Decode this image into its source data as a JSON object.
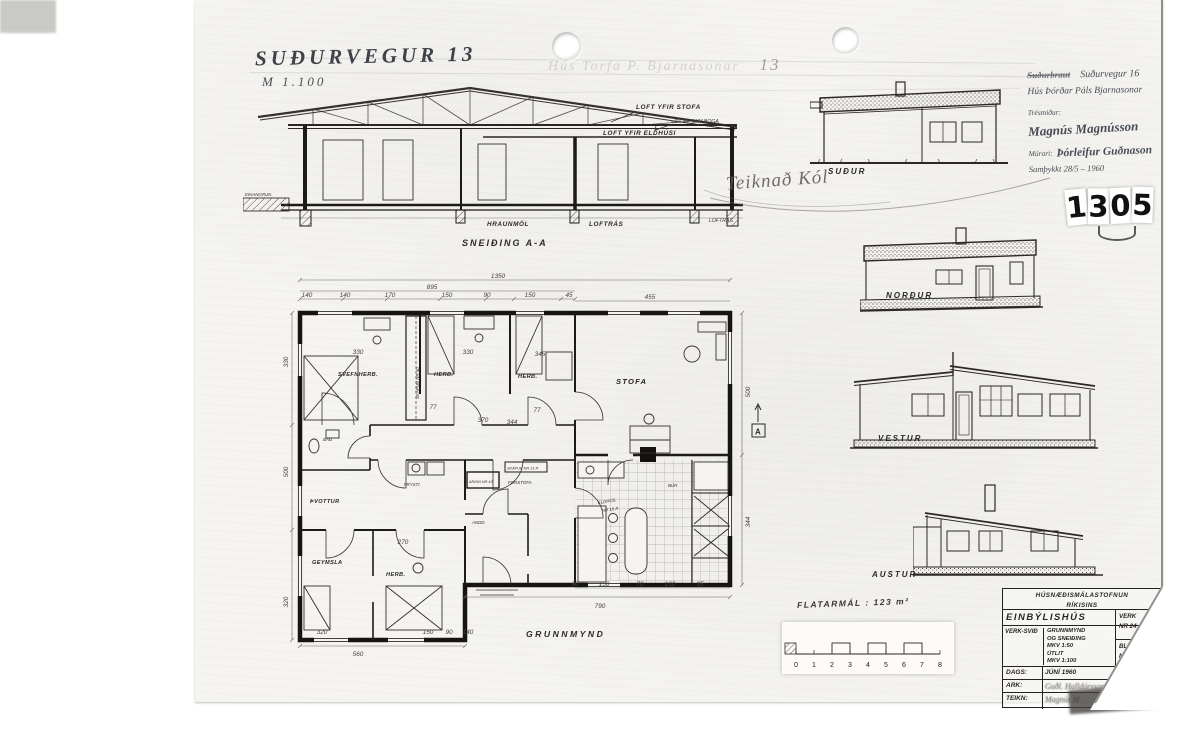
{
  "handwritten": {
    "address": "SUÐURVEGUR 13",
    "scale": "M 1.100",
    "faded_script": "Hús Torfa P. Bjarnasonar",
    "faded_number": "13",
    "check_note": "Teiknað Kól"
  },
  "info_block": {
    "line1_struck": "Suðurbraut",
    "line1": "Suðurvegur 16",
    "line2": "Hús Þórðar Páls Bjarnasonar",
    "line3_label": "Trésmiður:",
    "line3_sig": "Magnús Magnússon",
    "line4_label": "Múrari:",
    "line4_sig": "Þórleifur Guðnason",
    "line5": "Samþykkt 28/5 – 1960"
  },
  "stamp_number": {
    "d1": "1",
    "d2": "3",
    "d3": "0",
    "d4": "5"
  },
  "section": {
    "caption": "SNEIÐING A-A",
    "loft_stofa": "LOFT YFIR STOFA",
    "boga": "⌀2½\"×7\" M/M BOGA",
    "loft_eldhus": "LOFT YFIR ELDHÚSI",
    "hraunmol": "HRAUNMÖL",
    "loftras1": "LOFTRÁS",
    "loftras2": "LOFTRÁS",
    "einangrun": "EINANGRUN"
  },
  "elevations": {
    "south": "SUÐUR",
    "north": "NORÐUR",
    "west": "VESTUR",
    "east": "AUSTUR"
  },
  "plan": {
    "caption": "GRUNNMYND",
    "rooms": {
      "svefnherb": "SVEFNHERB.",
      "herb1": "HERB.",
      "herb2": "HERB.",
      "stofa": "STOFA",
      "bad": "BAÐ",
      "thvottur": "ÞVOTTUR",
      "frysti": "FRYSTI.",
      "andd": "ANDD.",
      "forstofa": "FORSTOFA",
      "eldhus1": "ELDHÚS",
      "eldhus2": "NR 16 A",
      "bur": "BÚR",
      "geymsla": "GEYMSLA",
      "herb3": "HERB.",
      "skapur": "SKÁPUR NR 40",
      "skapur2": "SKÁPUR NR 21 R",
      "arinn": "ARINN NR 43"
    },
    "marker_a": "A",
    "dims": [
      "1350",
      "895",
      "140",
      "140",
      "170",
      "150",
      "90",
      "150",
      "45",
      "455",
      "330",
      "330",
      "345",
      "370",
      "344",
      "77",
      "77",
      "270",
      "60",
      "150",
      "70",
      "130",
      "95",
      "790",
      "320",
      "150",
      "90",
      "140",
      "560",
      "330",
      "500",
      "320",
      "500",
      "344"
    ]
  },
  "area_note": "FLATARMÁL : 123 m²",
  "scalebar": {
    "numbers": [
      "0",
      "1",
      "2",
      "3",
      "4",
      "5",
      "6",
      "7",
      "8"
    ]
  },
  "titleblock": {
    "org1": "HÚSNÆÐISMÁLASTOFNUN",
    "org2": "RÍKISINS",
    "building_type": "EINBÝLISHÚS",
    "versvid_label": "VERK-SVIÐ",
    "mid_l1": "GRUNNMYND",
    "mid_l2": "OG SNEIÐING",
    "mid_l3": "MKV 1:50",
    "mid_l4": "ÚTLIT",
    "mid_l5": "MKV 1:100",
    "verk_label": "VERK",
    "verk_nr": "NR 24",
    "blad_label": "BLAÐ",
    "blad_nr": "NR 2",
    "dags_label": "DAGS:",
    "dags": "JÚNÍ 1960",
    "ark_label": "ARK:",
    "ark_sig": "Guðl. Halldórsson",
    "teikn_label": "TEIKN:",
    "teikn_sig": "Magnús M."
  }
}
